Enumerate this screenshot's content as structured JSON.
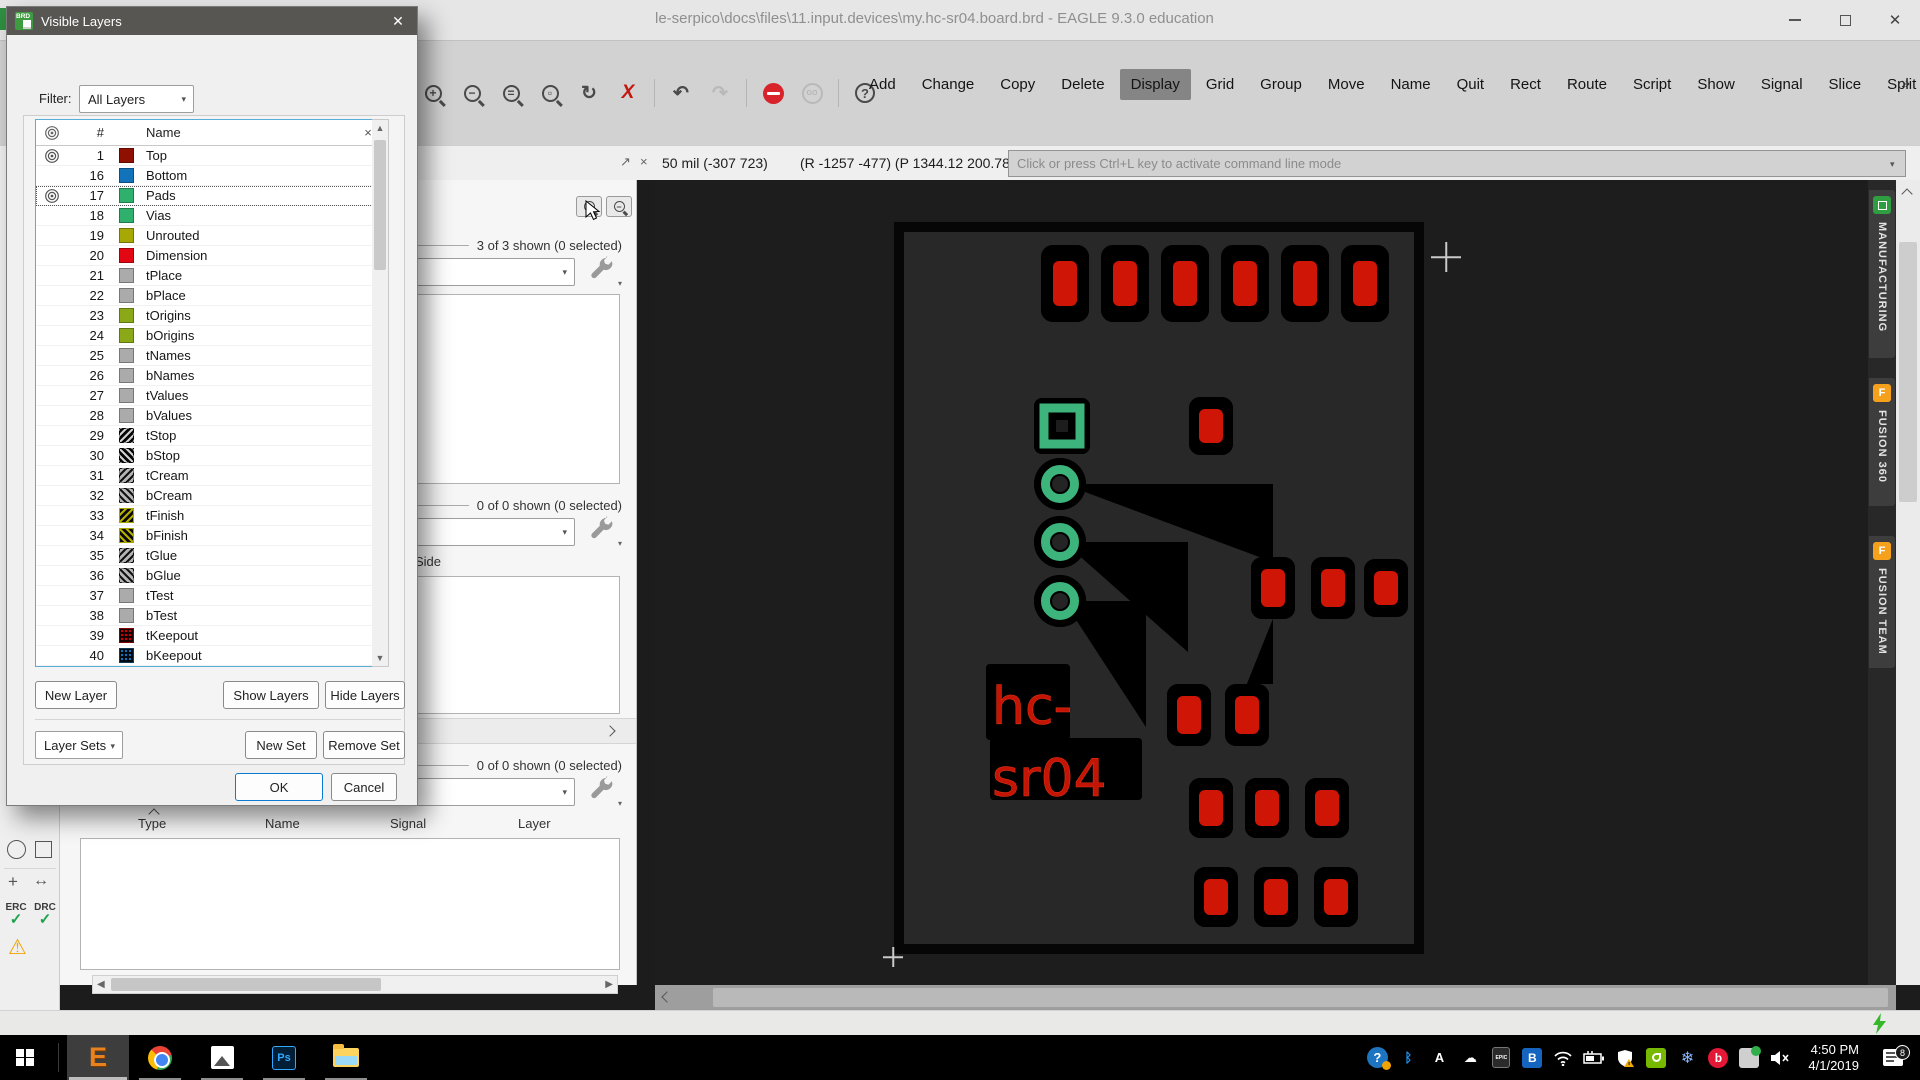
{
  "window": {
    "title": "le-serpico\\docs\\files\\11.input.devices\\my.hc-sr04.board.brd - EAGLE 9.3.0 education"
  },
  "icons": {
    "close": "✕",
    "small_close": "×",
    "float": "↗",
    "overflow": "»",
    "dropdown": "▾",
    "undo": "↶",
    "redo": "↷",
    "refresh": "↻",
    "measure": "↔",
    "origin_plus": "+",
    "go": "GO",
    "question": "?",
    "zoom_in": "+",
    "zoom_out": "−",
    "zoom_fit": "=",
    "cancel_x": "X",
    "check": "✓",
    "warning": "⚠",
    "hash": "#",
    "scroll_up": "▲",
    "scroll_down": "▼",
    "scroll_left": "◀",
    "scroll_right": "▶",
    "bluetooth": "ᛒ",
    "snowflake": "❄",
    "cloud": "☁",
    "mute": "✕"
  },
  "toolbar": {
    "commands": [
      {
        "label": "Add"
      },
      {
        "label": "Change"
      },
      {
        "label": "Copy"
      },
      {
        "label": "Delete"
      },
      {
        "label": "Display",
        "active": true
      },
      {
        "label": "Grid"
      },
      {
        "label": "Group"
      },
      {
        "label": "Move"
      },
      {
        "label": "Name"
      },
      {
        "label": "Quit"
      },
      {
        "label": "Rect"
      },
      {
        "label": "Route"
      },
      {
        "label": "Script"
      },
      {
        "label": "Show"
      },
      {
        "label": "Signal"
      },
      {
        "label": "Slice"
      },
      {
        "label": "Split"
      },
      {
        "label": "Text"
      },
      {
        "label": "Value"
      },
      {
        "label": "Via"
      }
    ]
  },
  "statusbar": {
    "grid_text": "50 mil (-307 723)",
    "position_text": "(R -1257 -477) (P 1344.12 200.78°)",
    "command_placeholder": "Click or press Ctrl+L key to activate command line mode"
  },
  "left_panel": {
    "section1_legend": "3 of 3 shown (0 selected)",
    "section2_legend": "0 of 0 shown (0 selected)",
    "section2_header": "Side",
    "section3_legend": "0 of 0 shown (0 selected)",
    "columns": [
      "Type",
      "Name",
      "Signal",
      "Layer"
    ]
  },
  "tools": {
    "erc": "ERC",
    "drc": "DRC"
  },
  "dialog": {
    "title": "Visible Layers",
    "icon_label": "BRD",
    "filter_label": "Filter:",
    "filter_value": "All Layers",
    "header_name": "Name",
    "layers": [
      {
        "num": "1",
        "name": "Top",
        "color": "#8f0f00",
        "pattern": "solid",
        "visible": true
      },
      {
        "num": "16",
        "name": "Bottom",
        "color": "#1272ba",
        "pattern": "solid",
        "visible": false
      },
      {
        "num": "17",
        "name": "Pads",
        "color": "#2fb06d",
        "pattern": "solid",
        "visible": true,
        "selected": true
      },
      {
        "num": "18",
        "name": "Vias",
        "color": "#2fb06d",
        "pattern": "solid",
        "visible": false
      },
      {
        "num": "19",
        "name": "Unrouted",
        "color": "#a8a805",
        "pattern": "solid",
        "visible": false
      },
      {
        "num": "20",
        "name": "Dimension",
        "color": "#e30613",
        "pattern": "solid",
        "visible": false
      },
      {
        "num": "21",
        "name": "tPlace",
        "color": "#ababab",
        "pattern": "solid",
        "visible": false
      },
      {
        "num": "22",
        "name": "bPlace",
        "color": "#ababab",
        "pattern": "solid",
        "visible": false
      },
      {
        "num": "23",
        "name": "tOrigins",
        "color": "#8ba819",
        "pattern": "solid",
        "visible": false
      },
      {
        "num": "24",
        "name": "bOrigins",
        "color": "#8ba819",
        "pattern": "solid",
        "visible": false
      },
      {
        "num": "25",
        "name": "tNames",
        "color": "#ababab",
        "pattern": "solid",
        "visible": false
      },
      {
        "num": "26",
        "name": "bNames",
        "color": "#ababab",
        "pattern": "solid",
        "visible": false
      },
      {
        "num": "27",
        "name": "tValues",
        "color": "#ababab",
        "pattern": "solid",
        "visible": false
      },
      {
        "num": "28",
        "name": "bValues",
        "color": "#ababab",
        "pattern": "solid",
        "visible": false
      },
      {
        "num": "29",
        "name": "tStop",
        "color": "#cfcfcf",
        "color2": "#050505",
        "pattern": "fwd",
        "visible": false
      },
      {
        "num": "30",
        "name": "bStop",
        "color": "#cfcfcf",
        "color2": "#050505",
        "pattern": "back",
        "visible": false
      },
      {
        "num": "31",
        "name": "tCream",
        "color": "#101010",
        "color2": "#b5b5b5",
        "pattern": "fwd",
        "visible": false
      },
      {
        "num": "32",
        "name": "bCream",
        "color": "#101010",
        "color2": "#b5b5b5",
        "pattern": "back",
        "visible": false
      },
      {
        "num": "33",
        "name": "tFinish",
        "color": "#b5ae00",
        "color2": "#080808",
        "pattern": "fwd",
        "border": "#a8a200",
        "visible": false
      },
      {
        "num": "34",
        "name": "bFinish",
        "color": "#b5ae00",
        "color2": "#080808",
        "pattern": "back",
        "border": "#a8a200",
        "visible": false
      },
      {
        "num": "35",
        "name": "tGlue",
        "color": "#101010",
        "color2": "#b5b5b5",
        "pattern": "fwd",
        "visible": false
      },
      {
        "num": "36",
        "name": "bGlue",
        "color": "#101010",
        "color2": "#b5b5b5",
        "pattern": "back",
        "visible": false
      },
      {
        "num": "37",
        "name": "tTest",
        "color": "#ababab",
        "pattern": "solid",
        "visible": false
      },
      {
        "num": "38",
        "name": "bTest",
        "color": "#ababab",
        "pattern": "solid",
        "visible": false
      },
      {
        "num": "39",
        "name": "tKeepout",
        "color": "#d00000",
        "color2": "#140000",
        "pattern": "dots",
        "border": "#800000",
        "visible": false
      },
      {
        "num": "40",
        "name": "bKeepout",
        "color": "#1272ba",
        "color2": "#00080f",
        "pattern": "dots",
        "border": "#0a3a60",
        "visible": false
      }
    ],
    "new_layer": "New Layer",
    "show_layers": "Show Layers",
    "hide_layers": "Hide Layers",
    "layer_sets": "Layer Sets",
    "new_set": "New Set",
    "remove_set": "Remove Set",
    "ok": "OK",
    "cancel": "Cancel"
  },
  "board": {
    "label_line1": "hc-",
    "label_line2": "sr04"
  },
  "right_tabs": [
    {
      "label": "MANUFACTURING"
    },
    {
      "label": "FUSION 360",
      "letter": "F"
    },
    {
      "label": "FUSION TEAM",
      "letter": "F"
    }
  ],
  "taskbar": {
    "time": "4:50 PM",
    "date": "4/1/2019",
    "notification_count": "8",
    "eagle_letter": "E",
    "ps_label": "Ps",
    "epic_label": "EPIC",
    "blue_b_label": "B",
    "beats_label": "b",
    "autodesk_label": "A",
    "question_label": "?"
  }
}
